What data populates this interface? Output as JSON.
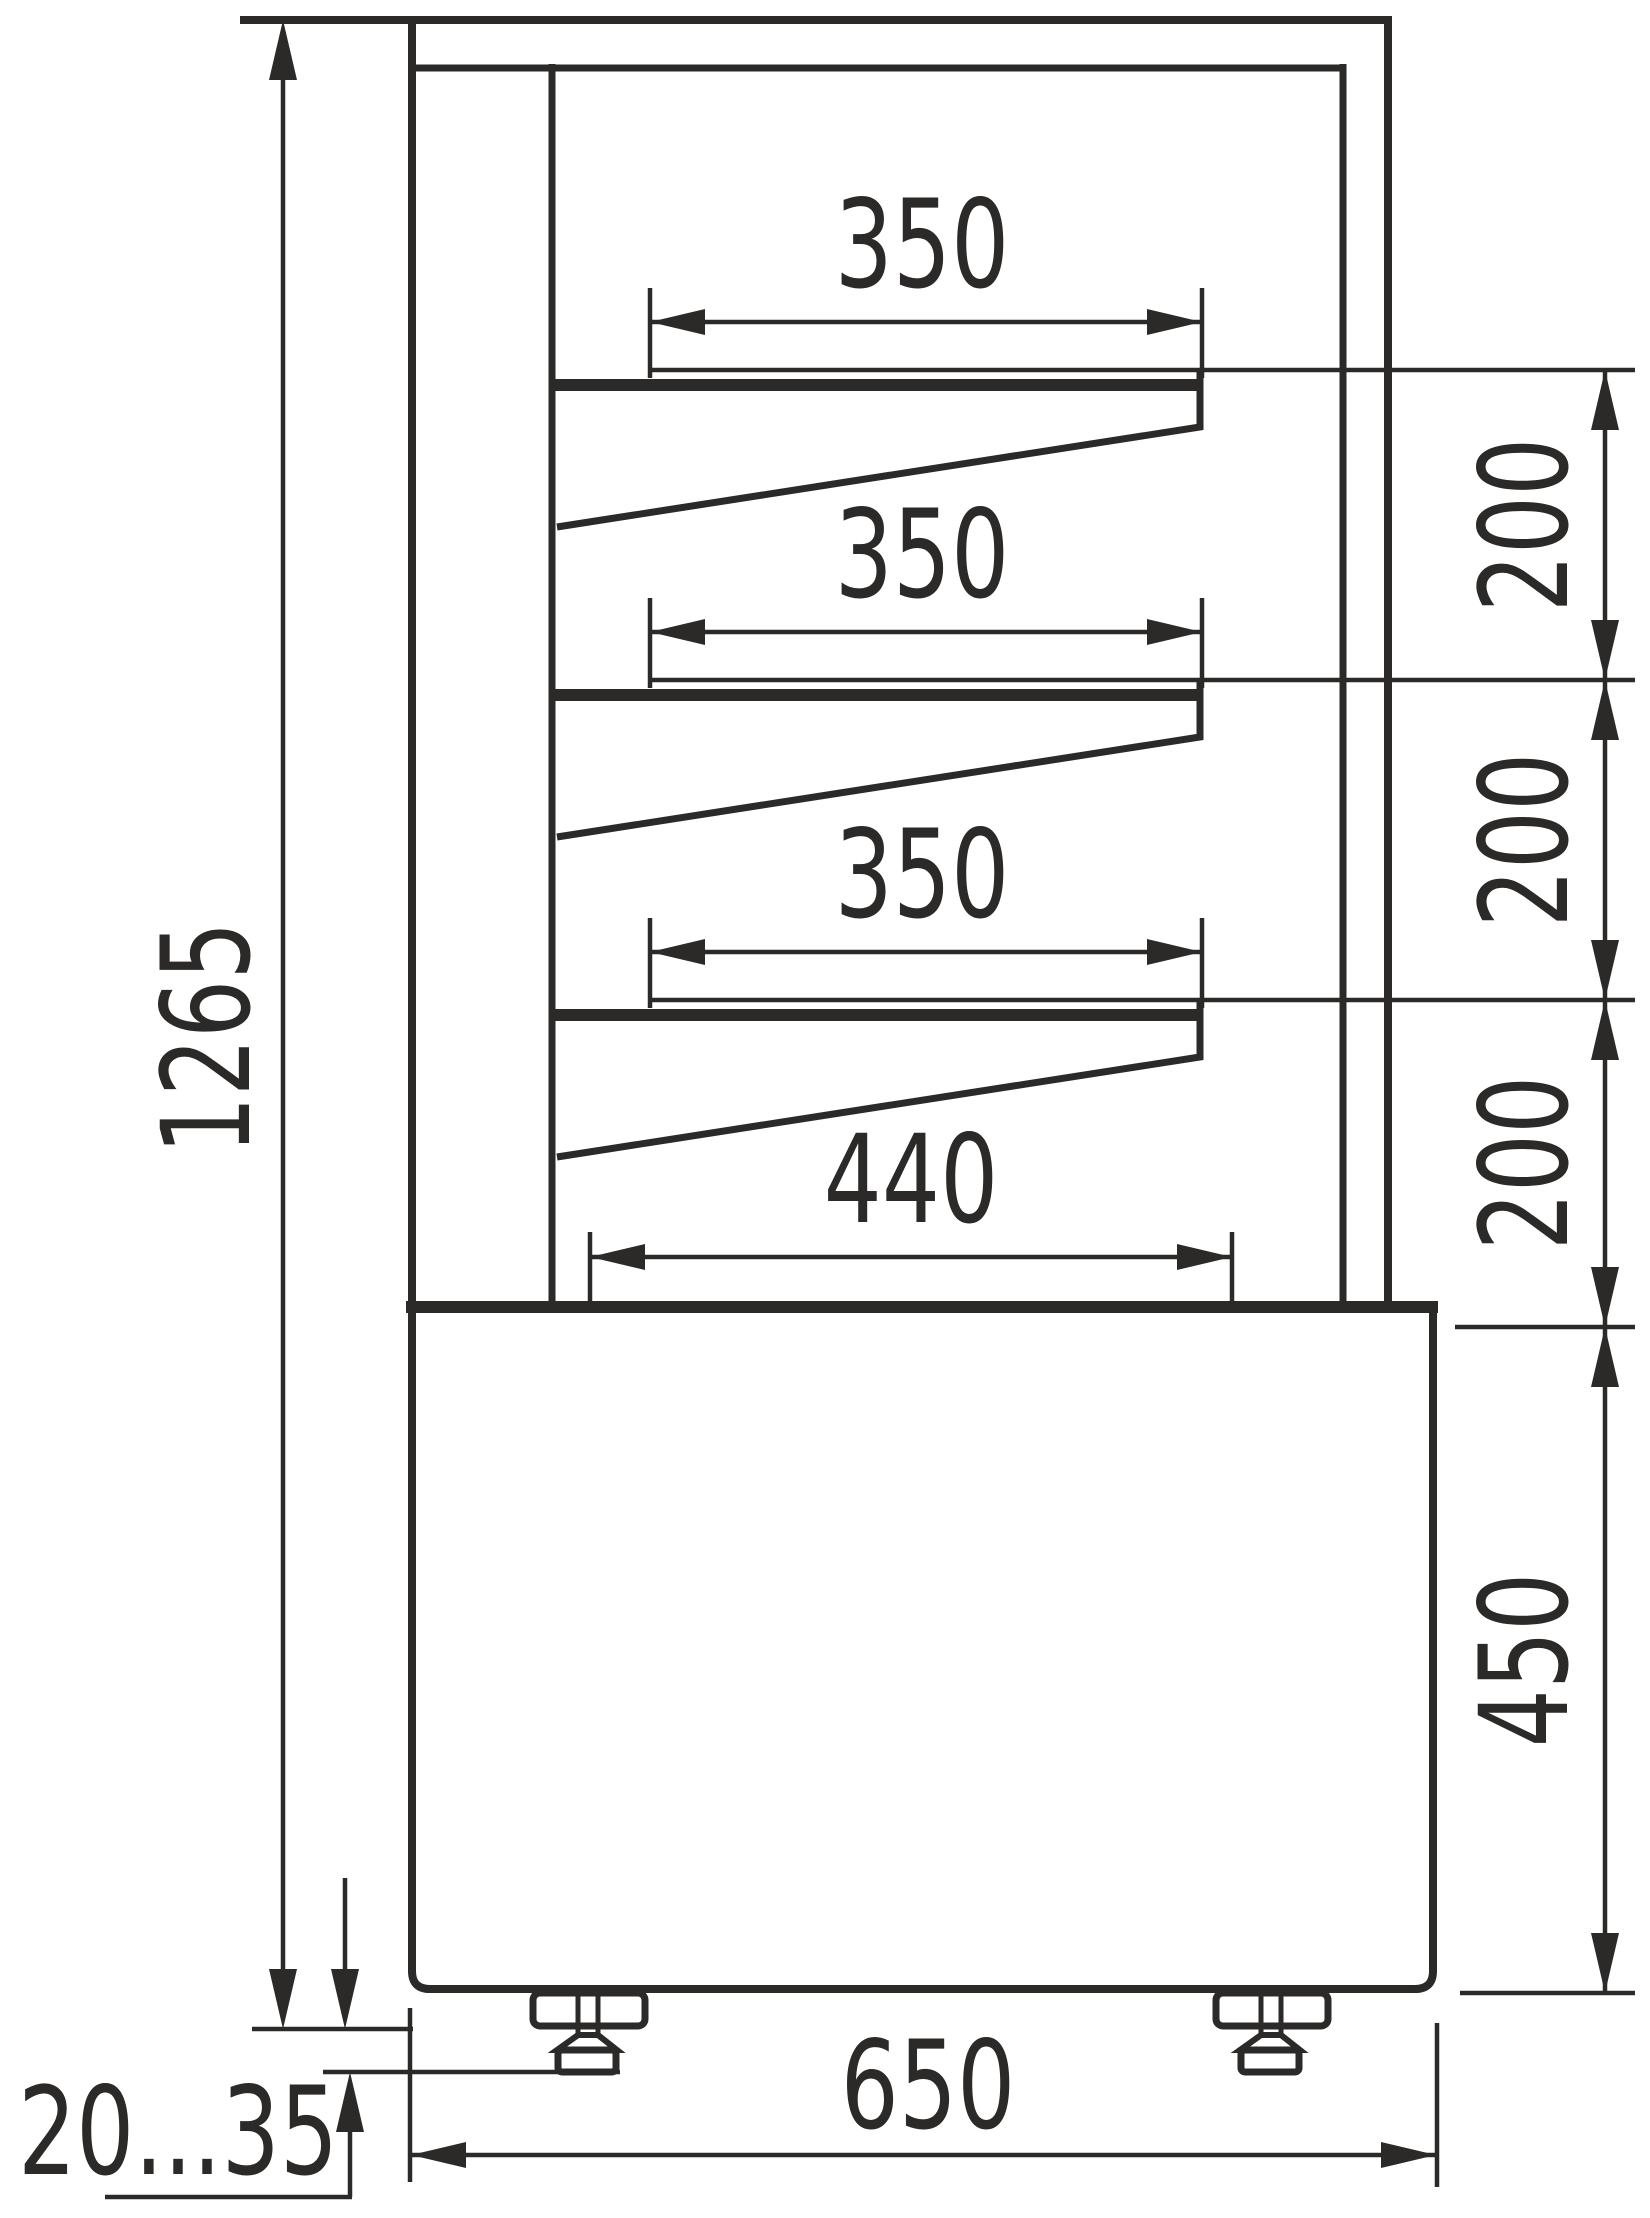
{
  "drawing_type": "technical-dimension-drawing",
  "subject": "display-case-side-view",
  "colors": {
    "line": "#2b2a29",
    "background": "#ffffff"
  },
  "labels": {
    "overall_height": "1265",
    "shelf_depth_1": "350",
    "shelf_depth_2": "350",
    "shelf_depth_3": "350",
    "shelf_gap_1": "200",
    "shelf_gap_2": "200",
    "shelf_gap_3": "200",
    "well_depth": "440",
    "base_height": "450",
    "overall_depth": "650",
    "feet_adjust_range": "20...35"
  },
  "dimensions_mm": {
    "overall_height": 1265,
    "shelf_depths": [
      350,
      350,
      350
    ],
    "shelf_spacings": [
      200,
      200,
      200
    ],
    "bottom_well_depth": 440,
    "base_height": 450,
    "overall_depth": 650,
    "feet_adjustment_min": 20,
    "feet_adjustment_max": 35
  }
}
